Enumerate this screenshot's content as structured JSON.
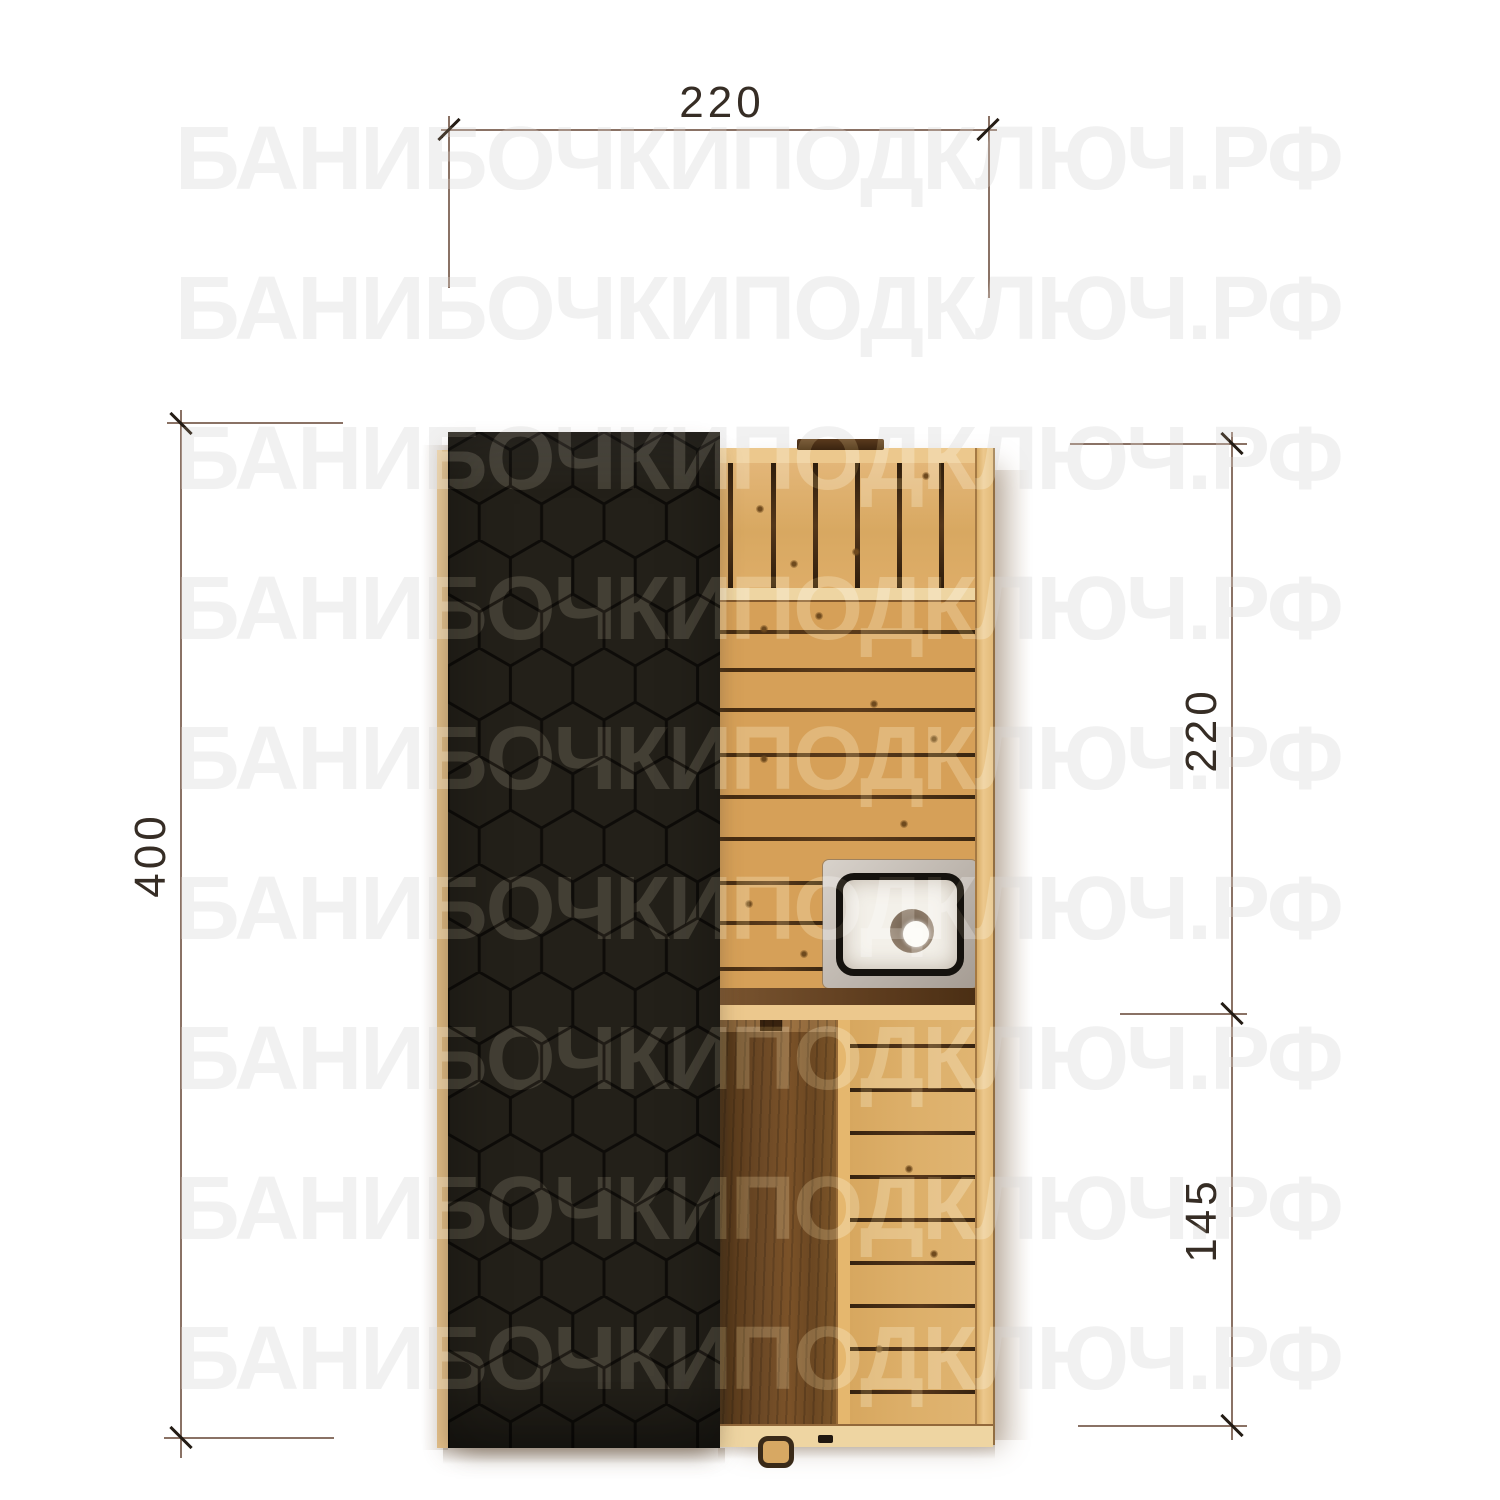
{
  "watermark": {
    "text": "БАНИБОЧКИПОДКЛЮЧ.РФ",
    "rows": 9
  },
  "dimensions": {
    "top_width": {
      "value": "220",
      "orientation": "horizontal",
      "position": "top"
    },
    "left_height": {
      "value": "400",
      "orientation": "vertical",
      "position": "left"
    },
    "right_upper": {
      "value": "220",
      "orientation": "vertical",
      "position": "right-upper"
    },
    "right_lower": {
      "value": "145",
      "orientation": "vertical",
      "position": "right-lower"
    }
  },
  "palette": {
    "background": "#ffffff",
    "watermark": "#ececec",
    "dim_line": "#8a7265",
    "dim_tick": "#241c15",
    "dim_label": "#362d25",
    "roof_fill": "#232019",
    "roof_line": "#0e0c09",
    "wood_base": "#d6a058",
    "wood_bright": "#ecc88d",
    "wood_pale": "#eed5a2",
    "gap_dark": "#3a2610",
    "walnut_door": "#6e4a26",
    "steel_light": "#d8d2cb",
    "steel_dark": "#a59c93",
    "basin": "#f3f0e9",
    "band_brown": "#5c3b1d"
  }
}
